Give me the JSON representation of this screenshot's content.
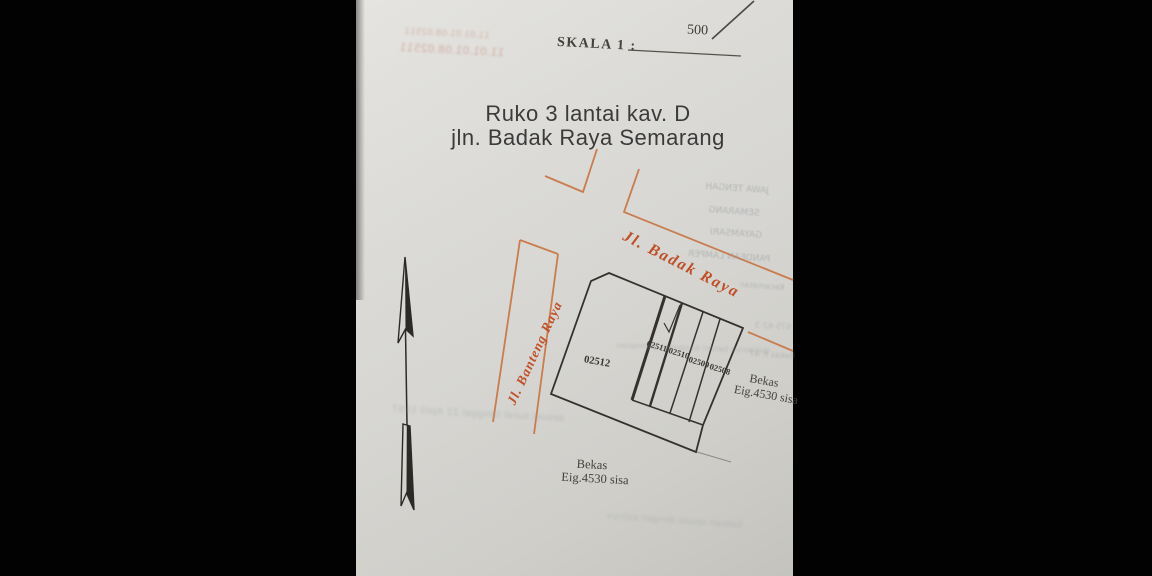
{
  "document": {
    "scale_label": "SKALA 1 :",
    "scale_value": "500",
    "title_line1": "Ruko 3 lantai kav. D",
    "title_line2": "jln. Badak Raya Semarang"
  },
  "roads": {
    "badak_raya": "Jl. Badak Raya",
    "banteng_raya": "Jl. Banteng Raya"
  },
  "parcels": [
    {
      "id": "02512"
    },
    {
      "id": "02511"
    },
    {
      "id": "02510"
    },
    {
      "id": "02509"
    },
    {
      "id": "02508"
    }
  ],
  "annotations": {
    "bekas_right_line1": "Bekas",
    "bekas_right_line2": "Eig.4530 sisa",
    "bekas_bottom_line1": "Bekas",
    "bekas_bottom_line2": "Eig.4530 sisa"
  },
  "bleedthrough": {
    "admin_region_1": "JAWA TENGAH",
    "admin_region_2": "SEMARANG",
    "admin_region_3": "GAYAMSARI",
    "admin_region_4": "PANDEAN LAMPER",
    "admin_region_5": "Kecamatan",
    "red_number_1": "11.01.01.08.02511",
    "red_number_2": "11.01.01.08.02511",
    "note_right": "diatasnya berdiri bangunan permanen",
    "note_right_2": "075-62-3",
    "note_right_3": "Bekas P. 47",
    "note_bottom_left": "sesuai surat tanggal 22 April 1997",
    "note_bottom": "Salinan sesuai dengan aslinya"
  },
  "colors": {
    "road_line": "#c97c4e",
    "road_text": "#bf4f28",
    "ink": "#35322e",
    "paper": "#d8d7d2"
  }
}
